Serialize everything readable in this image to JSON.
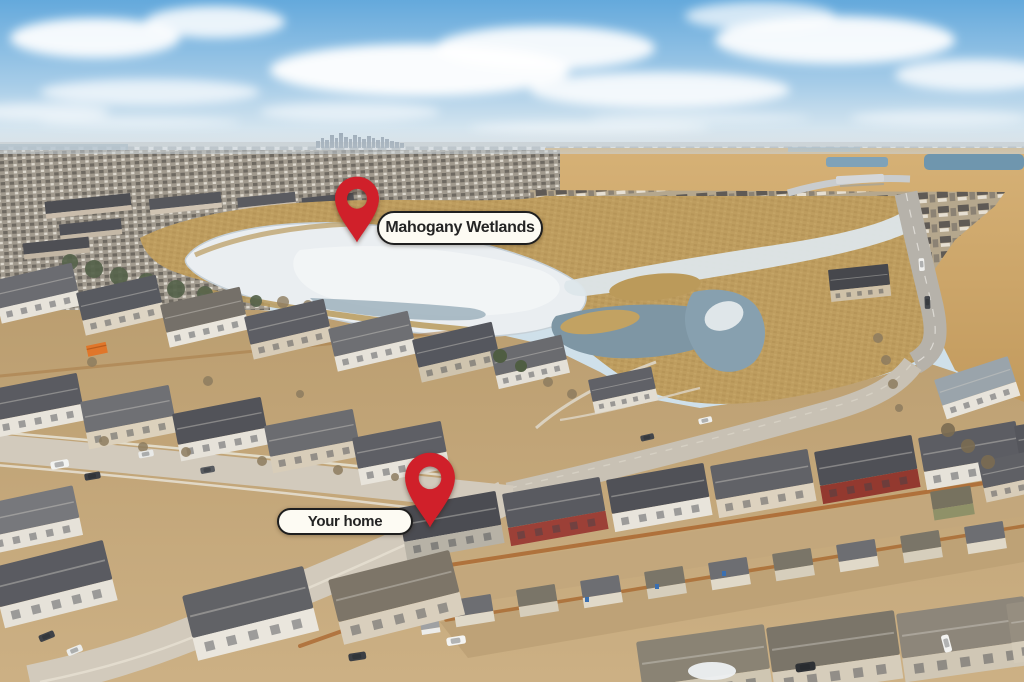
{
  "photo": {
    "description": "Winter aerial drone photo of a suburban lake community: frozen wetland mid-frame, downtown skyline on the horizon, golden fields and a curving parkway on the right, rows of two-storey homes with back-lane garages in the foreground.",
    "width_px": 1024,
    "height_px": 682
  },
  "annotations": {
    "wetlands_label": "Mahogany Wetlands",
    "home_label": "Your home",
    "pin_color": "#d0202a",
    "label_bg": "#fdfbf3",
    "label_border": "#1f1f1f",
    "label_text_color": "#242424"
  },
  "palette": {
    "sky_blue": "#64a9dc",
    "cloud_white": "#ffffff",
    "ice_white": "#eaeef1",
    "open_water": "#7e96a4",
    "reed_tan": "#bd9c5e",
    "field_gold": "#d0a967",
    "road_gray": "#cfc7ba",
    "roof_gray": "#5c5d63"
  }
}
